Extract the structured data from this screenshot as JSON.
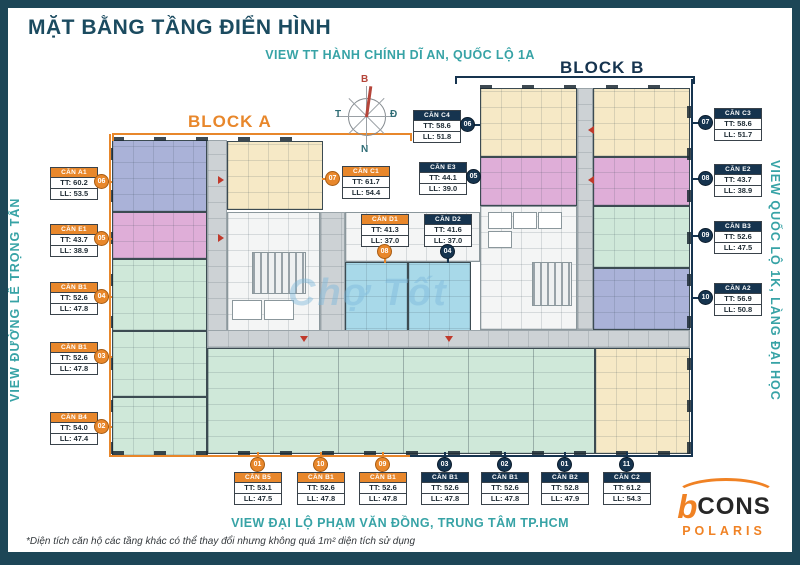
{
  "title": "MẶT BẰNG TẦNG ĐIỂN HÌNH",
  "views": {
    "top": "VIEW TT HÀNH CHÍNH DĨ AN, QUỐC LỘ 1A",
    "left": "VIEW ĐƯỜNG LÊ TRỌNG TẤN",
    "right": "VIEW QUỐC LỘ 1K, LÀNG ĐẠI HỌC",
    "bottom": "VIEW ĐẠI LỘ PHẠM VĂN ĐỒNG, TRUNG TÂM TP.HCM"
  },
  "blocks": {
    "a": "BLOCK A",
    "b": "BLOCK B"
  },
  "compass": {
    "n": "B",
    "e": "Đ",
    "w": "T",
    "s": "N"
  },
  "watermark": "Chợ Tốt",
  "footnote": "*Diện tích căn hộ các tầng khác có thể thay đổi nhưng không quá 1m² diện tích sử dụng",
  "logo": {
    "b": "b",
    "name": "CONS",
    "sub": "POLARIS"
  },
  "colors": {
    "accent_orange": "#e8872b",
    "accent_navy": "#16344f",
    "teal": "#37a3a6",
    "frame": "#1d4657",
    "unit_cream": "#f6e9c6",
    "unit_pink": "#dfaed8",
    "unit_blue": "#aab2d8",
    "unit_green": "#cfe8d9",
    "unit_cyan": "#a8d9e9",
    "corridor": "#cdd2d5"
  },
  "units": [
    {
      "block": "A",
      "name": "CĂN A1",
      "tt": "TT: 60.2",
      "ll": "LL: 53.5",
      "badge": "06"
    },
    {
      "block": "A",
      "name": "CĂN E1",
      "tt": "TT: 43.7",
      "ll": "LL: 38.9",
      "badge": "05"
    },
    {
      "block": "A",
      "name": "CĂN B1",
      "tt": "TT: 52.6",
      "ll": "LL: 47.8",
      "badge": "04"
    },
    {
      "block": "A",
      "name": "CĂN B1",
      "tt": "TT: 52.6",
      "ll": "LL: 47.8",
      "badge": "03"
    },
    {
      "block": "A",
      "name": "CĂN B4",
      "tt": "TT: 54.0",
      "ll": "LL: 47.4",
      "badge": "02"
    },
    {
      "block": "A",
      "name": "CĂN C1",
      "tt": "TT: 61.7",
      "ll": "LL: 54.4",
      "badge": "07"
    },
    {
      "block": "B",
      "name": "CĂN C4",
      "tt": "TT: 58.6",
      "ll": "LL: 51.8",
      "badge": "06"
    },
    {
      "block": "A",
      "name": "CĂN D1",
      "tt": "TT: 41.3",
      "ll": "LL: 37.0",
      "badge": "08"
    },
    {
      "block": "B",
      "name": "CĂN D2",
      "tt": "TT: 41.6",
      "ll": "LL: 37.0",
      "badge": "04"
    },
    {
      "block": "B",
      "name": "CĂN E3",
      "tt": "TT: 44.1",
      "ll": "LL: 39.0",
      "badge": "05"
    },
    {
      "block": "B",
      "name": "CĂN C3",
      "tt": "TT: 58.6",
      "ll": "LL: 51.7",
      "badge": "07"
    },
    {
      "block": "B",
      "name": "CĂN E2",
      "tt": "TT: 43.7",
      "ll": "LL: 38.9",
      "badge": "08"
    },
    {
      "block": "B",
      "name": "CĂN B3",
      "tt": "TT: 52.6",
      "ll": "LL: 47.5",
      "badge": "09"
    },
    {
      "block": "B",
      "name": "CĂN A2",
      "tt": "TT: 56.9",
      "ll": "LL: 50.8",
      "badge": "10"
    },
    {
      "block": "A",
      "name": "CĂN B5",
      "tt": "TT: 53.1",
      "ll": "LL: 47.5",
      "badge": "01"
    },
    {
      "block": "A",
      "name": "CĂN B1",
      "tt": "TT: 52.6",
      "ll": "LL: 47.8",
      "badge": "10"
    },
    {
      "block": "A",
      "name": "CĂN B1",
      "tt": "TT: 52.6",
      "ll": "LL: 47.8",
      "badge": "09"
    },
    {
      "block": "B",
      "name": "CĂN B1",
      "tt": "TT: 52.6",
      "ll": "LL: 47.8",
      "badge": "03"
    },
    {
      "block": "B",
      "name": "CĂN B1",
      "tt": "TT: 52.6",
      "ll": "LL: 47.8",
      "badge": "02"
    },
    {
      "block": "B",
      "name": "CĂN B2",
      "tt": "TT: 52.8",
      "ll": "LL: 47.9",
      "badge": "01"
    },
    {
      "block": "B",
      "name": "CĂN C2",
      "tt": "TT: 61.2",
      "ll": "LL: 54.3",
      "badge": "11"
    }
  ]
}
